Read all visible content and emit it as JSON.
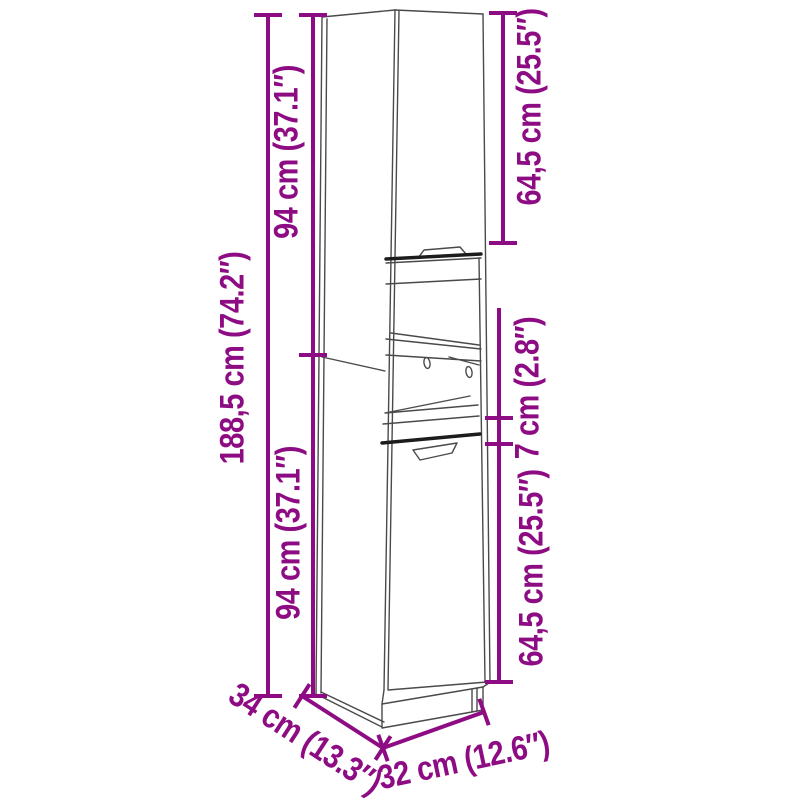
{
  "colors": {
    "accent": "#8E0C83",
    "line": "#4A4A4A",
    "line_dark": "#1C1C1C",
    "background": "#FFFFFF"
  },
  "figure": {
    "kind": "product dimension diagram",
    "subject": "tall narrow two-door cabinet with open middle shelf compartment"
  },
  "dimensions": {
    "total_height": "188,5 cm (74.2″)",
    "upper_section_height": "94 cm (37.1″)",
    "lower_section_height": "94 cm (37.1″)",
    "upper_door_height": "64,5 cm (25.5″)",
    "middle_band_height": "7 cm (2.8″)",
    "lower_door_height": "64,5 cm (25.5″)",
    "depth": "34 cm (13.3″)",
    "width": "32 cm (12.6″)"
  }
}
